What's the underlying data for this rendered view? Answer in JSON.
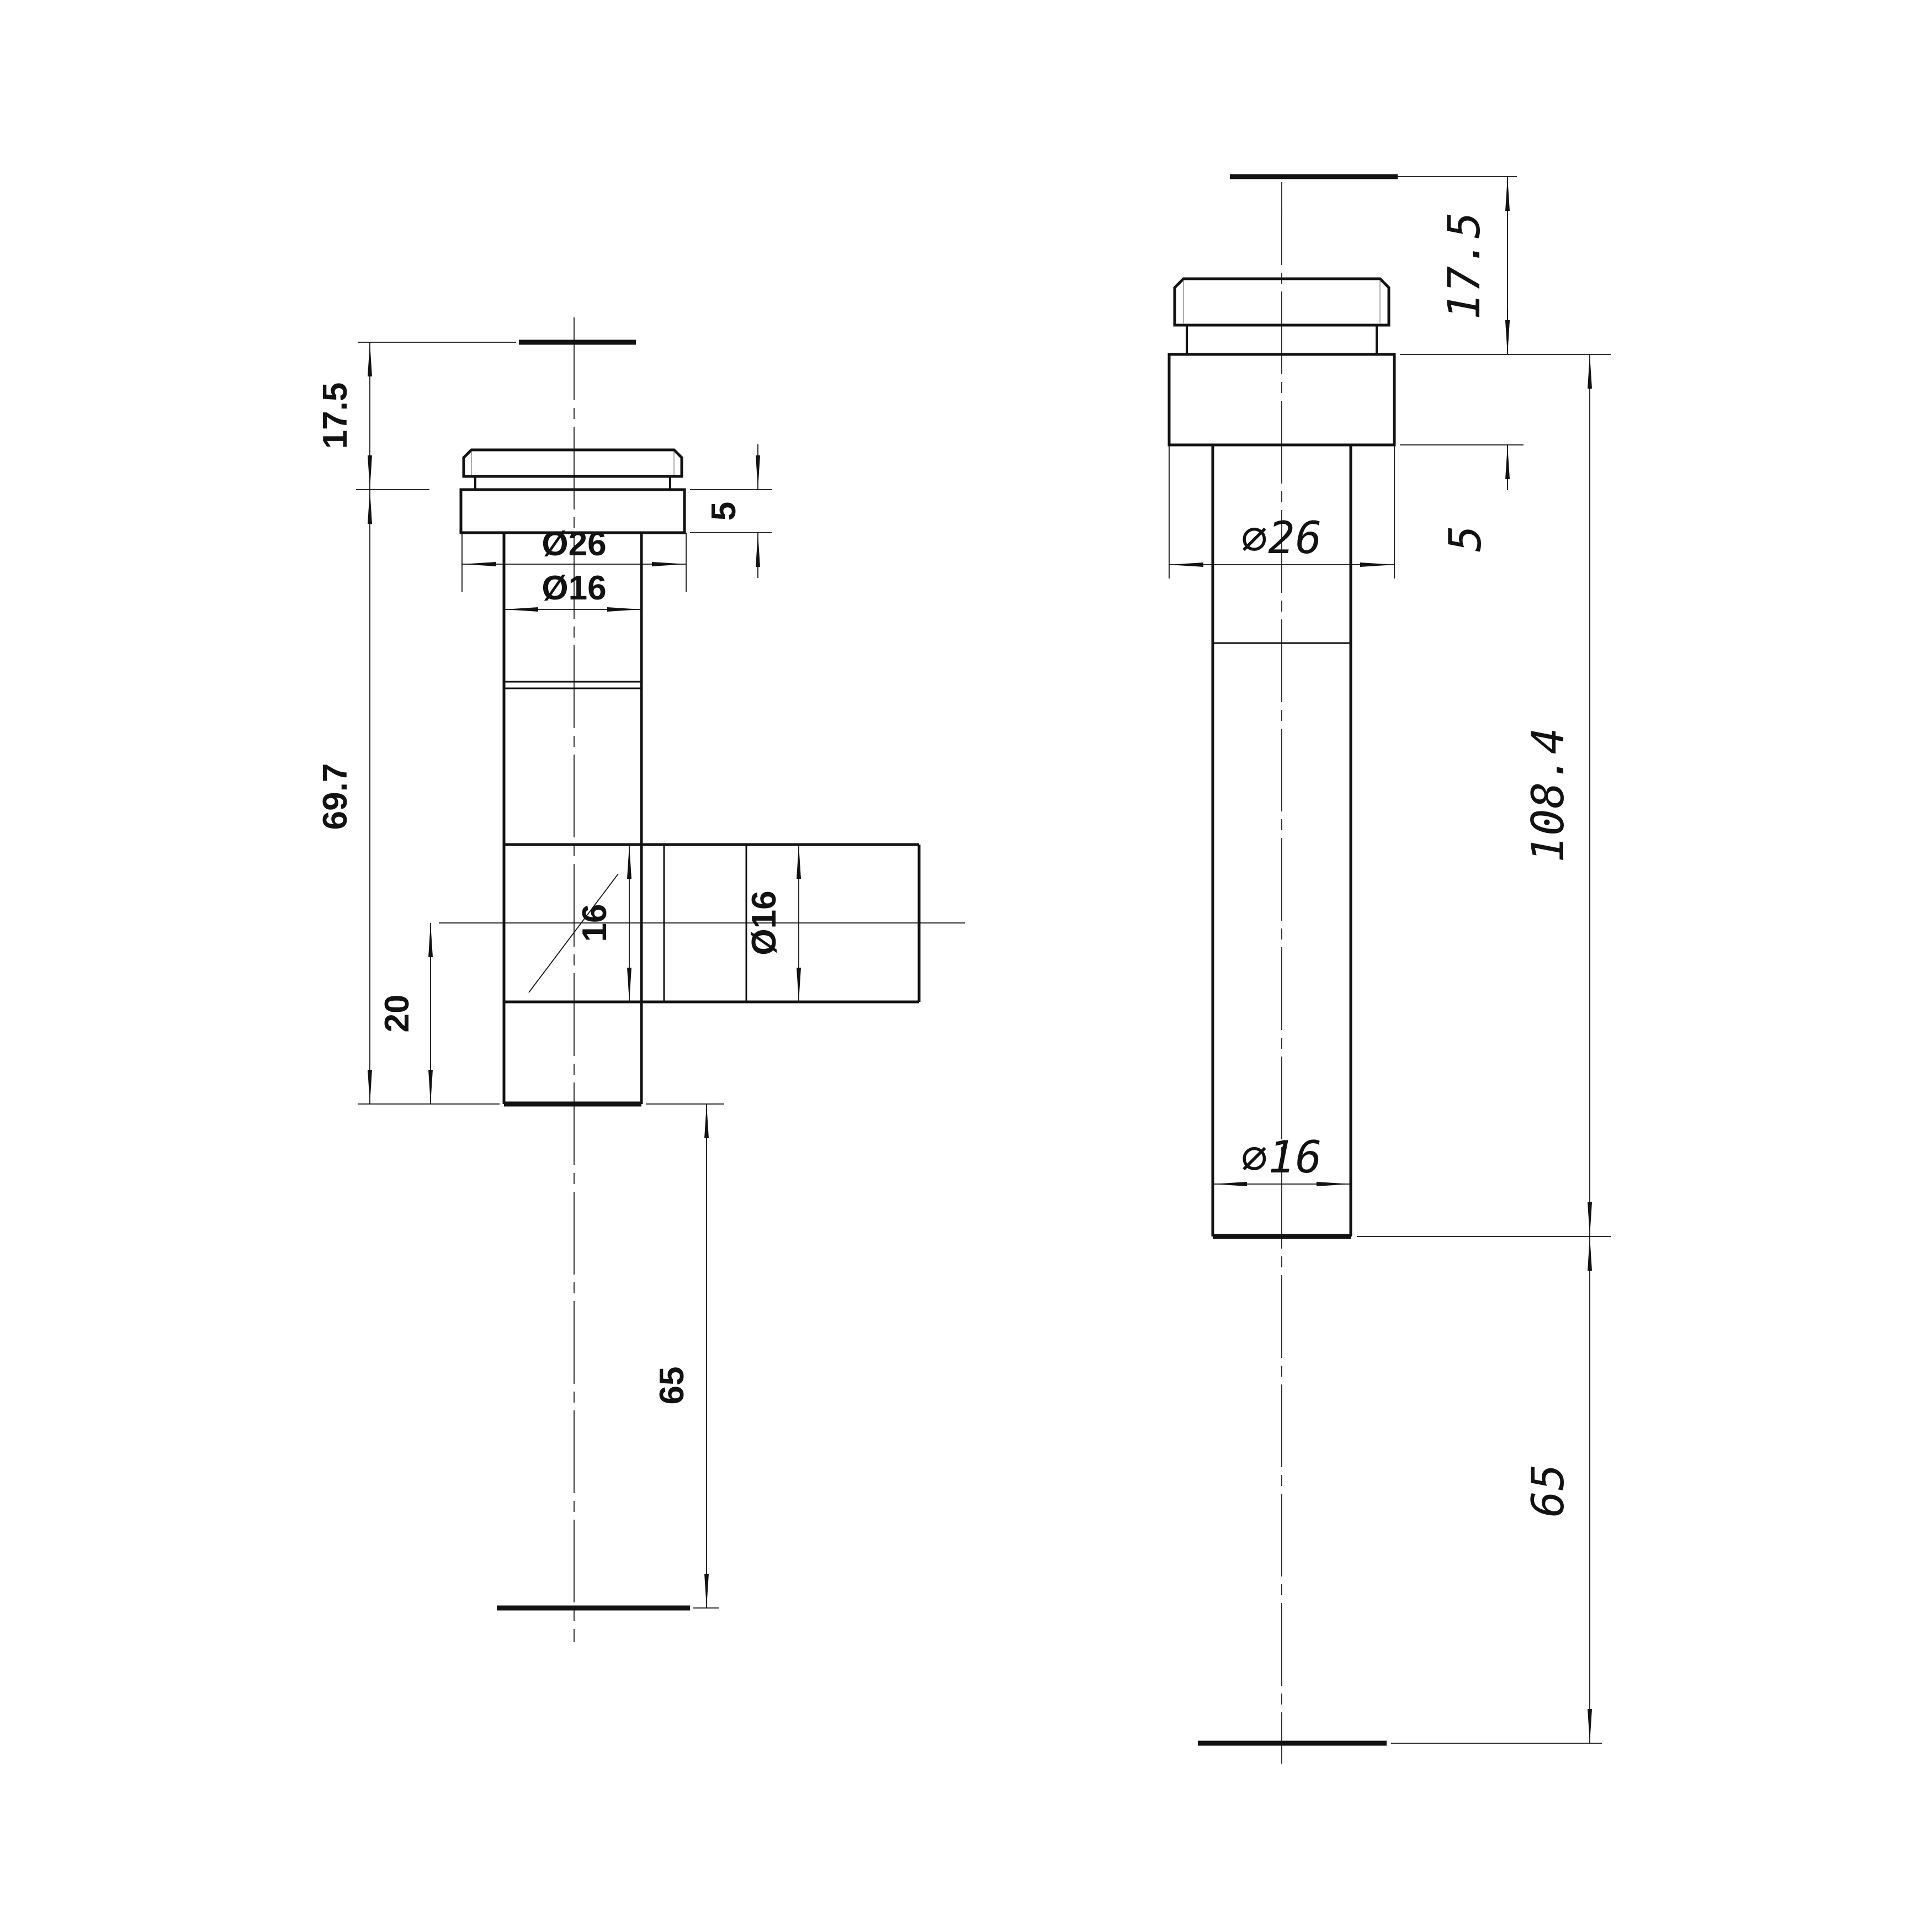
{
  "drawing": {
    "background": "#ffffff",
    "line_color": "#121212",
    "views": {
      "left": {
        "name": "tee-fitting-side-view",
        "labels": {
          "cap_height": "17.5",
          "flange_thickness": "5",
          "flange_diameter": "Ø26",
          "upper_tube_diameter": "Ø16",
          "body_height": "69.7",
          "branch_bore": "16",
          "branch_diameter": "Ø16",
          "branch_center_offset": "20",
          "lower_stub_length": "65"
        }
      },
      "right": {
        "name": "straight-fitting-side-view",
        "labels": {
          "cap_height": "17.5",
          "flange_thickness": "5",
          "flange_diameter": "∅26",
          "body_length": "108.4",
          "tube_diameter": "∅16",
          "lower_stub_length": "65"
        }
      }
    }
  }
}
